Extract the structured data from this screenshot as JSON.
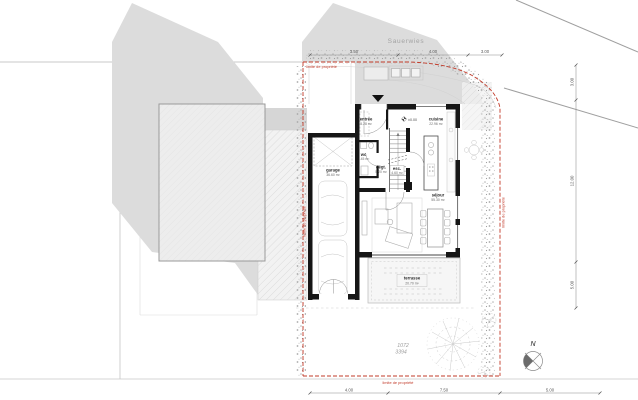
{
  "street": {
    "name": "Sauerwies"
  },
  "boundary": {
    "label": "limite de propriété",
    "color": "#c23b2a"
  },
  "parcel": {
    "upper": "1072",
    "lower": "3394"
  },
  "north": {
    "label": "N"
  },
  "level_marker": {
    "label": "±0.00"
  },
  "rooms": {
    "entree": {
      "name": "entrée",
      "area": "5.28 m²"
    },
    "wc": {
      "name": "wc",
      "area": "1.45 m²"
    },
    "degt": {
      "name": "dégt.",
      "area": "5.20 m²"
    },
    "esc": {
      "name": "esc.",
      "area": "4.60 m²"
    },
    "garage": {
      "name": "garage",
      "area": "36.60 m²"
    },
    "cuisine": {
      "name": "cuisine",
      "area": "22.96 m²"
    },
    "sejour": {
      "name": "séjour",
      "area": "55.30 m²"
    },
    "terrasse": {
      "name": "terrasse",
      "area": "20.70 m²"
    }
  },
  "dimensions": {
    "top": [
      "3.50",
      "4.00",
      "3.00"
    ],
    "right": [
      "3.00",
      "12.00",
      "5.00"
    ],
    "bottom": [
      "4.00",
      "7.50",
      "5.00"
    ]
  }
}
